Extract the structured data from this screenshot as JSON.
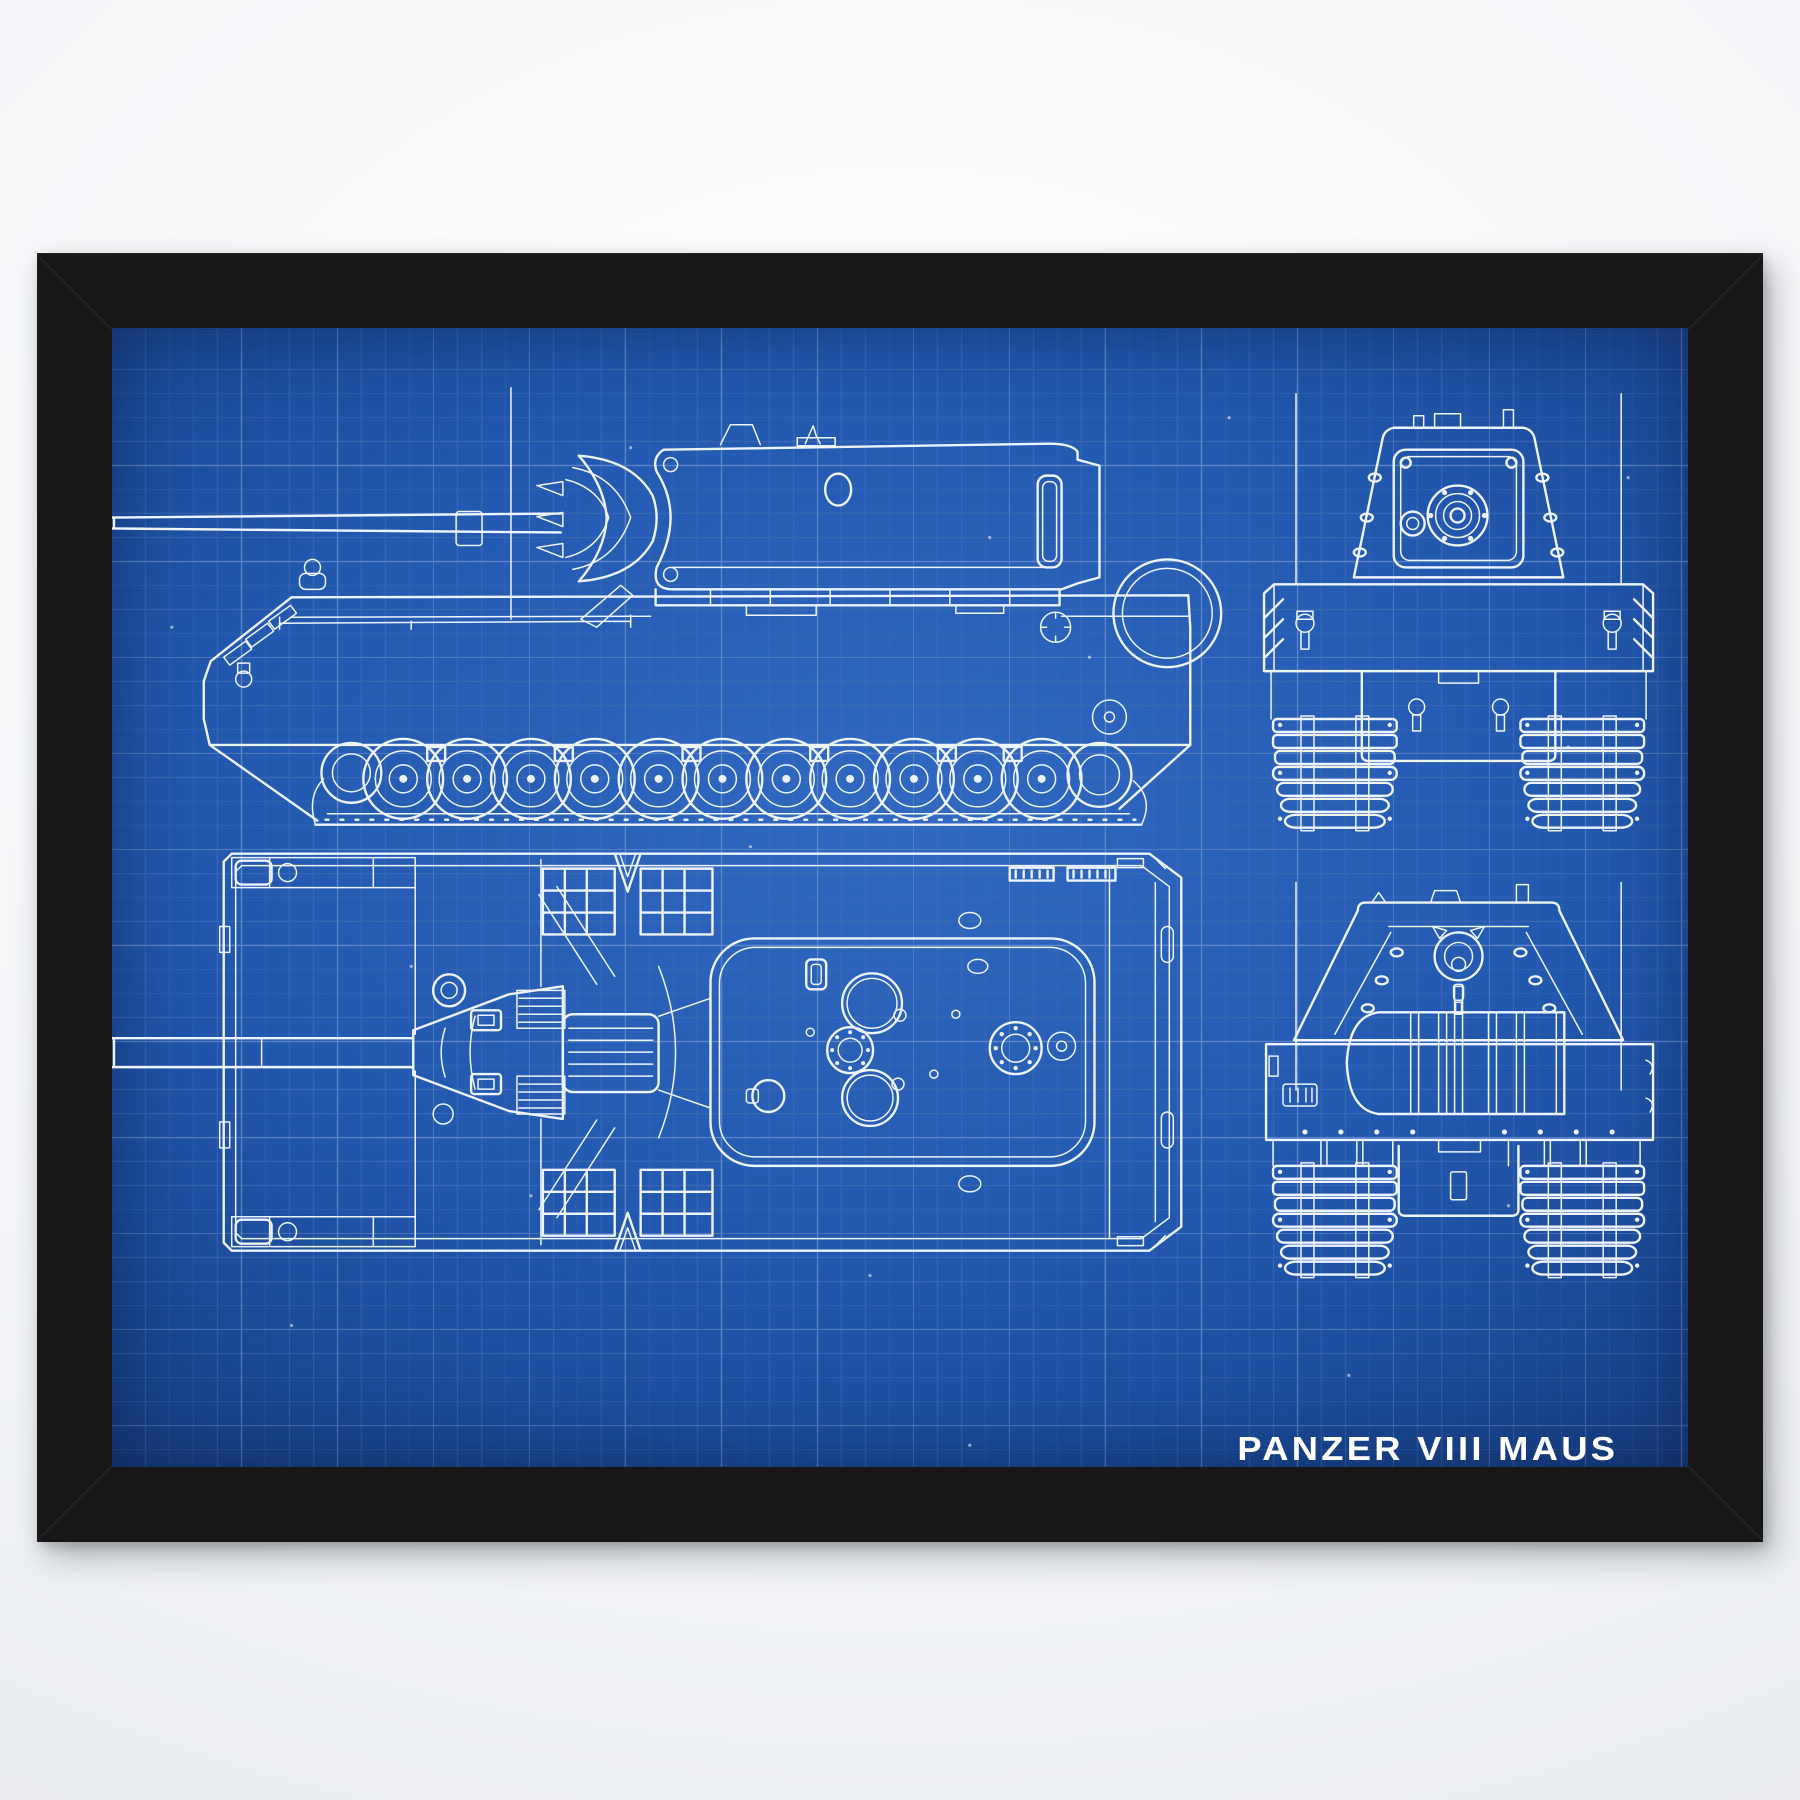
{
  "poster": {
    "title": "PANZER VIII MAUS",
    "subject": "tank-blueprint-four-orthographic-views",
    "views": [
      "side-view",
      "front-view",
      "top-view",
      "rear-view"
    ],
    "colors": {
      "background_page": "#f1f3f6",
      "frame": "#171717",
      "blueprint_blue": "#1f53a8",
      "blueprint_blue_light": "#2a62bd",
      "blueprint_blue_dark": "#143a7a",
      "grid_minor": "#3566b2",
      "grid_major": "#5b84c8",
      "line_art": "#eef4fb",
      "title_text": "#ffffff"
    },
    "grid": {
      "minor_px": 24,
      "major_px": 96
    }
  }
}
